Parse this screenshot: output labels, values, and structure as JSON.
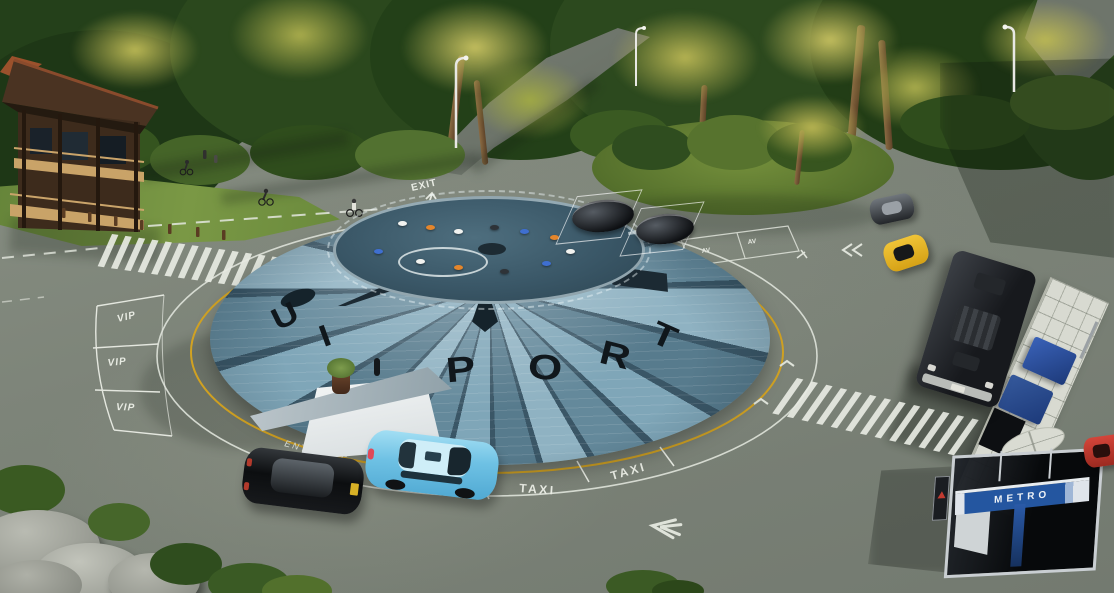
{
  "dome": {
    "letters": [
      "U",
      "I",
      "P",
      "O",
      "R",
      "T"
    ]
  },
  "markings": {
    "exit": "EXIT",
    "entrance": "ENTRANCE",
    "vip": [
      "VIP",
      "VIP",
      "VIP"
    ],
    "taxi": [
      "TAXI",
      "TAXI"
    ],
    "av": [
      "AV",
      "AV"
    ]
  },
  "signs": {
    "metro": "METRO"
  },
  "icons": {
    "exit-arrow": "arrow-up",
    "entrance-arrow": "chevron-left",
    "lane-arrow": "double-chevron-left",
    "guide-arrows": "small-chevrons"
  },
  "colors": {
    "pavement": "#7d847a",
    "forest": "#2c461d",
    "palm_highlight": "#b9b654",
    "dome_panel_light": "#8fb2c2",
    "dome_panel_dark": "#577b8d",
    "dome_deck": "#3a5767",
    "dome_letters": "#10171c",
    "ring_yellow": "#d7a41f",
    "marking_white": "#e8ebe3",
    "taxi_car": "#6ec1e4",
    "sedan_car": "#0d0f11",
    "sports_car": "#e7b71f",
    "red_car": "#c03428",
    "bus": "#24272c",
    "platform": "#d8dad1",
    "metro_sign_blue": "#2456a0",
    "house_wood": "#3d2b1c",
    "house_rail": "#c9a368",
    "grass": "#6f8f3f",
    "drone_colors": [
      "#e4862c",
      "#f2f3f0",
      "#3f6fd0",
      "#2e3338"
    ]
  }
}
